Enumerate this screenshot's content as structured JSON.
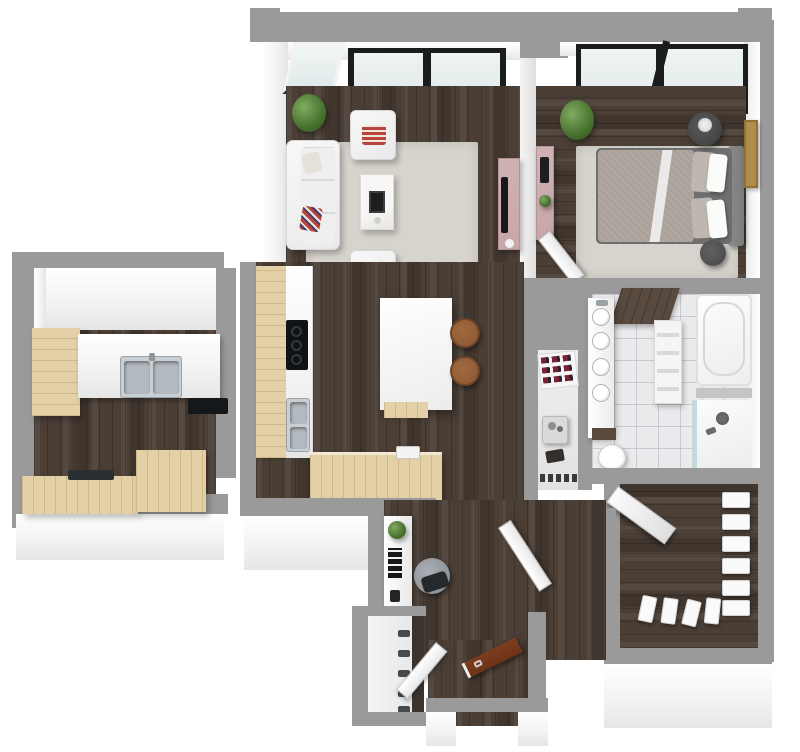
{
  "meta": {
    "scene": "3d-apartment-floor-plan",
    "style": "top-down dollhouse render, no text labels",
    "canvas": {
      "width_px": 800,
      "height_px": 752
    }
  },
  "palette": {
    "wall_gray": "#9a9a9a",
    "wall_face": "#f4f4f4",
    "floor_dark": "#4a3e35",
    "wood_light": "#e4d0a6",
    "tile": "#ebebed",
    "rug": "#d7d4cd",
    "furn_white": "#f3f3f3",
    "accent_pink": "#c7a6aa",
    "red_pillow": "#b8433a",
    "wood_brown": "#8a5733",
    "door_brown": "#6e3318",
    "frame_black": "#1b1c1e",
    "glass": "#e3ebeb",
    "glass_dark": "#9fb0b0",
    "plant_green": "#49712f",
    "steel": "#c9ced2",
    "art_gold": "#b08d4a",
    "bed_gray": "#aaa29a",
    "headboard_gray": "#7b7b7b"
  },
  "rooms": [
    {
      "name": "living-room",
      "floor": "dark-wood-plank",
      "furniture": [
        "sofa",
        "armchair-top",
        "armchair-bottom",
        "marble-coffee-table",
        "book-stack",
        "area-rug",
        "pink-tv-console",
        "tv",
        "potted-plant",
        "corner-window",
        "black-frame-window-wall"
      ]
    },
    {
      "name": "bedroom",
      "floor": "dark-wood-plank",
      "furniture": [
        "double-bed",
        "gray-duvet",
        "pillows",
        "headboard",
        "round-nightstand",
        "flower-vase",
        "round-ottoman",
        "area-rug",
        "pink-media-console",
        "leaning-gold-artwork",
        "potted-plant",
        "black-frame-window-wall",
        "open-door"
      ]
    },
    {
      "name": "kitchen-dining",
      "floor": "dark-wood-plank",
      "furniture": [
        "l-shaped-counter",
        "black-cooktop",
        "double-steel-sink",
        "base-cabinet-run",
        "prep-sink",
        "white-island",
        "wood-bar-chair",
        "wood-bar-chair"
      ]
    },
    {
      "name": "kitchen-annex",
      "floor": "dark-wood-plank",
      "furniture": [
        "tall-wood-cabinet",
        "white-counter",
        "double-steel-sink",
        "black-cooktop",
        "base-cabinets",
        "dark-tray"
      ]
    },
    {
      "name": "bathroom",
      "floor": "marble-tile",
      "furniture": [
        "floating-vanity",
        "vessel-sink-1",
        "vessel-sink-2",
        "vessel-sink-3",
        "vessel-sink-4",
        "wood-counter-slab",
        "towel-ladder",
        "bathtub",
        "walk-in-shower",
        "shower-head",
        "glass-panel",
        "toilet",
        "wood-shelf"
      ]
    },
    {
      "name": "storage-closet",
      "floor": "light-gray",
      "furniture": [
        "shoe-rack",
        "utility-cart",
        "bags",
        "shoe-row"
      ]
    },
    {
      "name": "walk-in-closet",
      "floor": "dark-wood-plank",
      "furniture": [
        "ironing-board",
        "hanging-clothes-right",
        "hanging-clothes-bottom"
      ]
    },
    {
      "name": "laundry-nook",
      "furniture": [
        "stacked-white-cabinets"
      ]
    },
    {
      "name": "office-nook",
      "floor": "dark-wood-plank",
      "furniture": [
        "white-desk",
        "desk-plant",
        "book-stack",
        "office-chair",
        "shoe-shelf",
        "open-door"
      ]
    },
    {
      "name": "entry",
      "floor": "dark-wood-plank",
      "furniture": [
        "open-front-door-brown",
        "open-door-white",
        "threshold"
      ]
    }
  ]
}
